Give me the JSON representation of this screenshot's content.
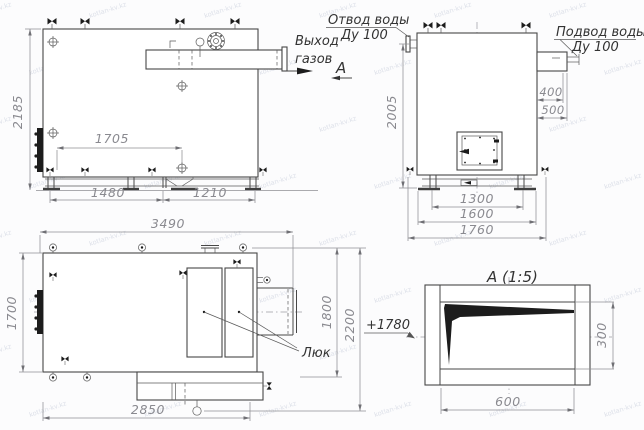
{
  "watermark": {
    "text": "kotlan-kv.kz"
  },
  "colors": {
    "ink": "#474747",
    "dim_text": "#8a8a90"
  },
  "side_view": {
    "dim_height": "2185",
    "dim_span": "1705",
    "dim_base_left": "1480",
    "dim_base_right": "1210",
    "label_gas_line1": "Выход",
    "label_gas_line2": "газов",
    "view_arrow": "А"
  },
  "front_view": {
    "outlet_line1": "Отвод воды",
    "outlet_line2": "Ду 100",
    "inlet_line1": "Подвод воды",
    "inlet_line2": "Ду 100",
    "dim_height": "2005",
    "dim_400": "400",
    "dim_500": "500",
    "dim_1300": "1300",
    "dim_1600": "1600",
    "dim_1760": "1760"
  },
  "plan_view": {
    "dim_width": "3490",
    "dim_depth": "1700",
    "dim_bottom": "2850",
    "dim_right_inner": "1800",
    "dim_right_outer": "2200",
    "label_hatch": "Люк"
  },
  "detail_view": {
    "title": "А (1:5)",
    "elevation": "+1780",
    "dim_width": "600",
    "dim_height": "300"
  }
}
